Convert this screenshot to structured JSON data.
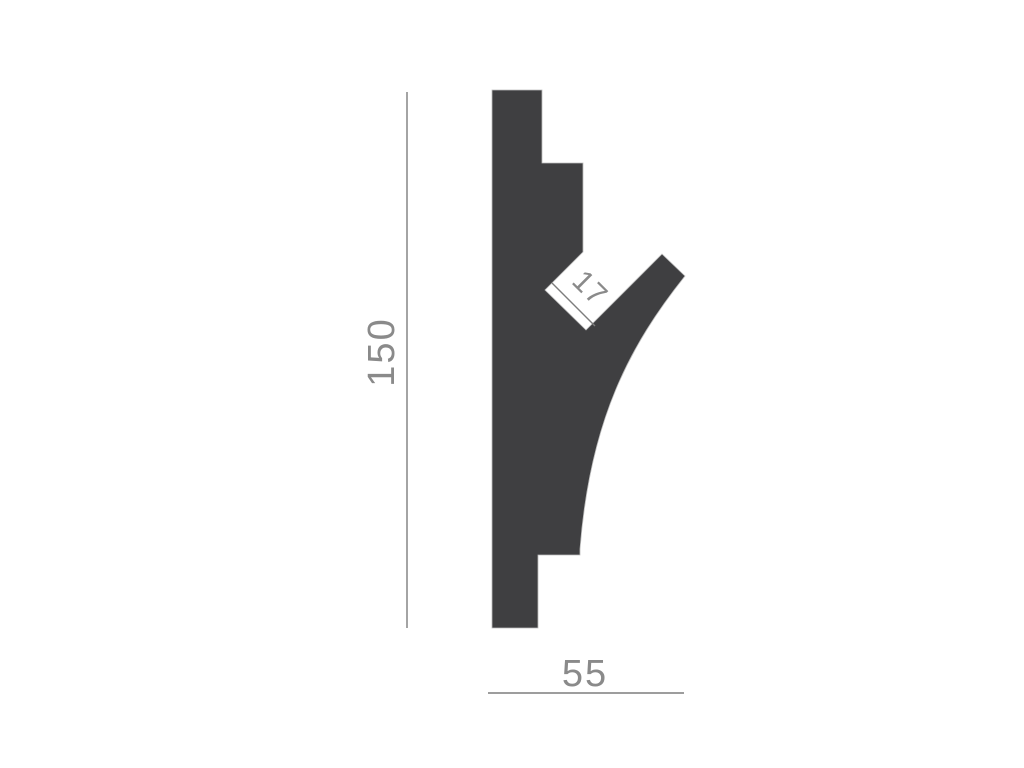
{
  "diagram": {
    "type": "technical-profile-cross-section",
    "background_color": "#ffffff",
    "shape_fill_color": "#3f3f41",
    "dimension_line_color": "#7d7d7d",
    "dimension_text_color": "#8a8a8a",
    "dimensions": {
      "height": {
        "label": "150",
        "orientation": "vertical"
      },
      "width": {
        "label": "55",
        "orientation": "horizontal"
      },
      "slot": {
        "label": "17",
        "orientation": "diagonal-45deg"
      }
    }
  }
}
